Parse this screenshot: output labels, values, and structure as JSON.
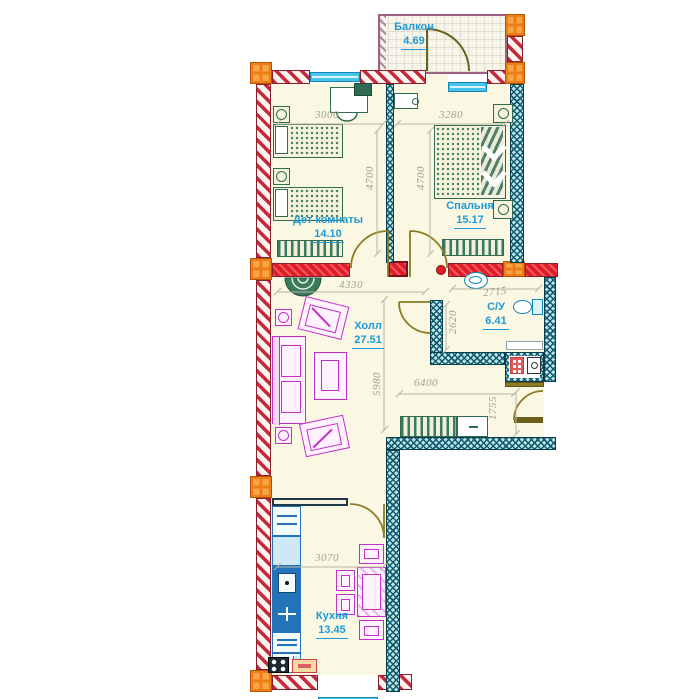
{
  "plan_type": "apartment-floor-plan",
  "rooms": {
    "balcony": {
      "label": "Балкон",
      "area": "4.69"
    },
    "kids": {
      "label": "Дет комнаты",
      "area": "14.10"
    },
    "bedroom": {
      "label": "Спальня",
      "area": "15.17"
    },
    "hall": {
      "label": "Холл",
      "area": "27.51"
    },
    "bath": {
      "label": "С/У",
      "area": "6.41"
    },
    "kitchen": {
      "label": "Кухня",
      "area": "13.45"
    }
  },
  "dims": {
    "kids_w": "3000",
    "bedroom_w": "3280",
    "kids_h": "4700",
    "bedroom_h": "4700",
    "hall_w": "4330",
    "bath_w": "2715",
    "bath_h": "2620",
    "hall_h": "5980",
    "corridor_w": "6400",
    "entry_h": "1755",
    "kitchen_w": "3070"
  },
  "colors": {
    "wall_brick": "#c5293a",
    "wall_concrete": "#0d5b6b",
    "wall_highlight": "#e21b25",
    "column": "#ed7d17",
    "window": "#49c3ec",
    "furniture_green": "#2e6b52",
    "furniture_magenta": "#c52fc9",
    "kitchen_blue": "#2273b8",
    "door": "#8d7c25",
    "label_blue": "#1f9ad6",
    "dimension_gray": "#a5a193",
    "balcony_wall": "#9c6383"
  }
}
